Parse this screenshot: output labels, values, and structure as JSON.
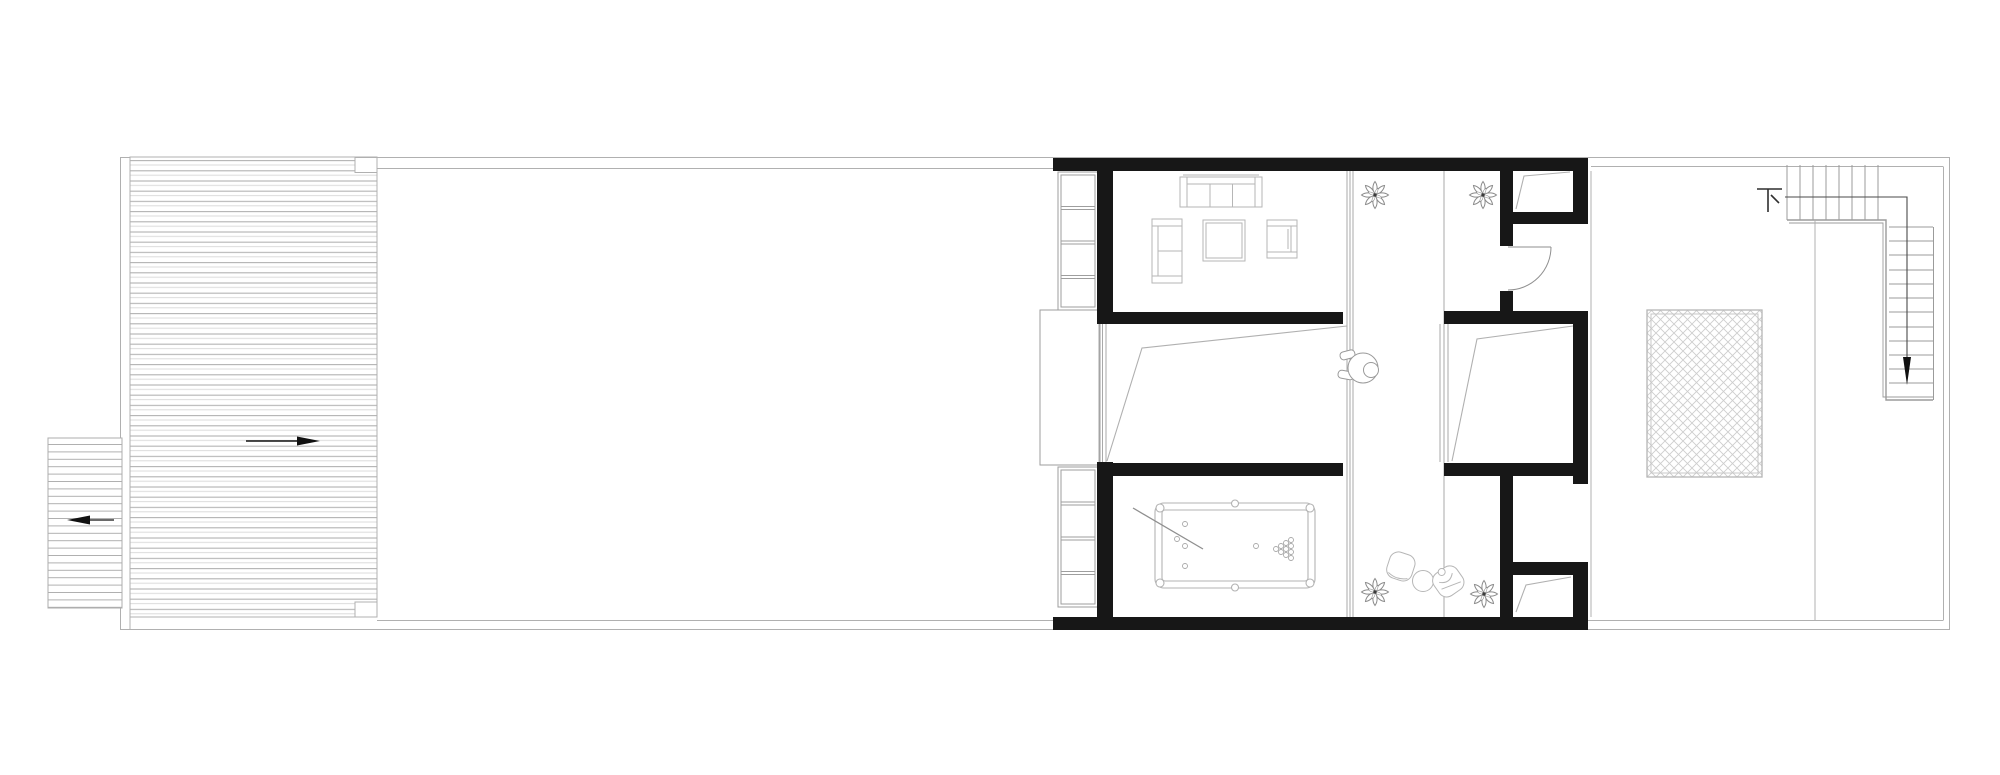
{
  "labels": {
    "stair_direction": "下"
  },
  "colors": {
    "background": "#ffffff",
    "wall": "#171717",
    "site_line": "#b0b0b0",
    "deck_stripe_dark": "#b2b2b2",
    "deck_stripe_light": "#dcdcdc",
    "furniture_line": "#b6b6b6",
    "stair_line": "#9b9b9b",
    "plant_line": "#8a8a8a",
    "arrow_black": "#111111"
  },
  "icons": [
    "plant-icon",
    "person-icon",
    "arrow-right-icon",
    "arrow-left-icon",
    "arrow-down-icon",
    "stair-down-glyph"
  ],
  "arrows": {
    "deck_direction": "right",
    "side_ramp_direction": "left",
    "stair_direction": "down"
  }
}
